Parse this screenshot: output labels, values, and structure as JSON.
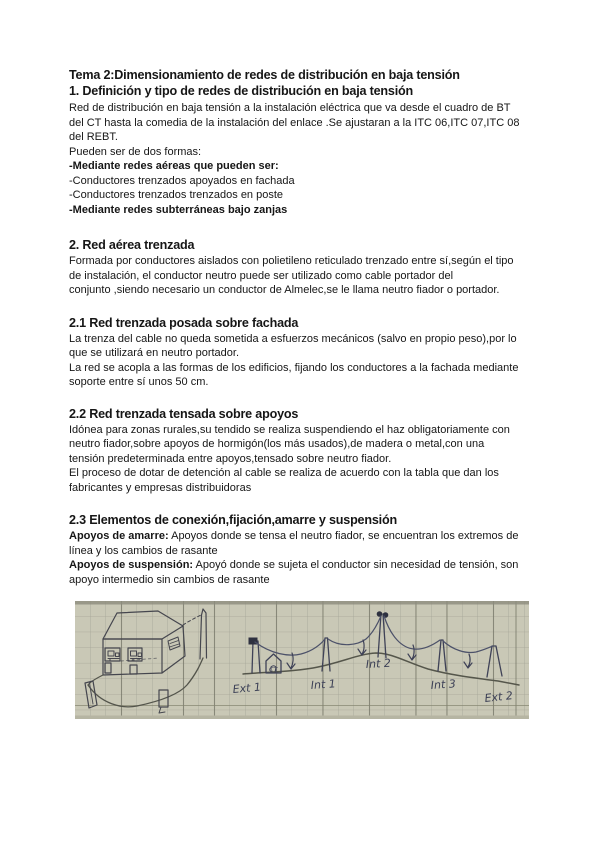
{
  "document": {
    "title": "Tema 2:Dimensionamiento de redes de distribución en baja tensión",
    "sections": [
      {
        "heading": "1. Definición y tipo de redes de distribución en baja tensión",
        "lines": [
          {
            "text": "Red de distribución en baja tensión a la instalación eléctrica que va desde el cuadro de BT",
            "bold": false
          },
          {
            "text": "del CT hasta la comedia de la instalación del enlace .Se ajustaran a la ITC 06,ITC 07,ITC 08",
            "bold": false
          },
          {
            "text": "del REBT.",
            "bold": false
          },
          {
            "text": "Pueden ser de dos formas:",
            "bold": false
          },
          {
            "text": "-Mediante redes aéreas que pueden ser:",
            "bold": true
          },
          {
            "text": "-Conductores trenzados apoyados en fachada",
            "bold": false
          },
          {
            "text": "-Conductores trenzados trenzados en poste",
            "bold": false
          },
          {
            "text": "-Mediante redes subterráneas bajo zanjas",
            "bold": true
          }
        ]
      },
      {
        "heading": "2. Red aérea trenzada",
        "body": "Formada por conductores aislados con polietileno reticulado trenzado entre sí,según el tipo\nde instalación, el conductor neutro puede ser utilizado como cable portador del\nconjunto ,siendo necesario un conductor de Almelec,se le llama neutro fiador o portador."
      },
      {
        "heading": "2.1 Red trenzada posada sobre fachada",
        "body": "La trenza del cable no queda sometida a esfuerzos mecánicos (salvo en propio peso),por lo\nque se utilizará en neutro portador.\nLa red se acopla a las formas de los edificios, fijando los conductores a la fachada mediante\nsoporte entre sí unos 50 cm."
      },
      {
        "heading": "2.2 Red trenzada tensada sobre apoyos",
        "body": "Idónea para zonas rurales,su tendido se realiza suspendiendo el haz obligatoriamente con\nneutro fiador,sobre apoyos de hormigón(los más usados),de madera o metal,con una\ntensión predeterminada entre apoyos,tensado sobre neutro fiador.\nEl proceso de dotar de detención al cable se realiza de acuerdo con la tabla que dan los\nfabricantes y empresas distribuidoras"
      },
      {
        "heading": "2.3 Elementos de conexión,fijación,amarre y suspensión",
        "terms": [
          {
            "label": "Apoyos de amarre:",
            "text": " Apoyos donde se tensa el neutro fiador, se encuentran los extremos de línea y los cambios de rasante"
          },
          {
            "label": "Apoyos de suspensión:",
            "text": " Apoyó donde se sujeta el conductor sin necesidad de tensión, son apoyo intermedio sin cambios de rasante"
          }
        ]
      }
    ]
  },
  "figure": {
    "description": "Hand-drawn sketch on graph paper: house with posada-sobre-fachada line, and tensada line over five poles",
    "ct_label": "CT",
    "pole_labels": [
      "Ext 1",
      "Int 1",
      "Int 2",
      "Int 3",
      "Ext 2"
    ],
    "colors": {
      "paper": "#c9c8b6",
      "grid": "#a4a496",
      "grid_dark": "#6e6e60",
      "ink": "#43465a",
      "ground": "#55564b",
      "cable": "#4c5169"
    }
  }
}
